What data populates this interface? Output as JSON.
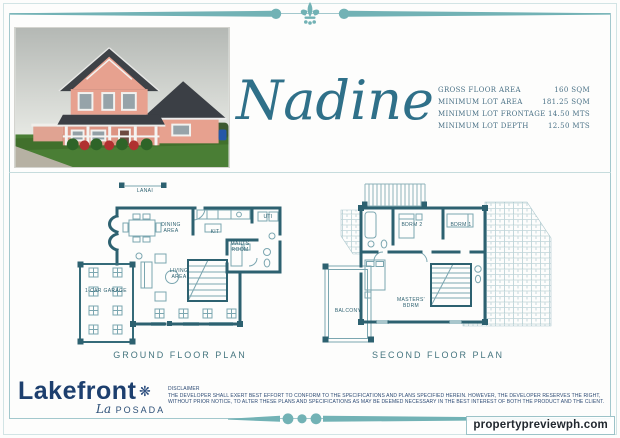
{
  "title": {
    "model_name": "Nadine"
  },
  "specs": {
    "rows": [
      {
        "label": "GROSS FLOOR AREA",
        "value": "160 SQM"
      },
      {
        "label": "MINIMUM LOT AREA",
        "value": "181.25 SQM"
      },
      {
        "label": "MINIMUM LOT FRONTAGE",
        "value": "14.50  MTS"
      },
      {
        "label": "MINIMUM LOT DEPTH",
        "value": "12.50  MTS"
      }
    ]
  },
  "ground_plan": {
    "caption": "GROUND FLOOR PLAN",
    "labels": {
      "lanai": "LANAI",
      "dining": "DINING AREA",
      "kitchen": "KIT",
      "utility": "UTI",
      "maids_room": "MAID'S ROOM",
      "living": "LIVING AREA",
      "garage": "1-CAR GARAGE"
    }
  },
  "second_plan": {
    "caption": "SECOND FLOOR PLAN",
    "labels": {
      "bdrm2": "BDRM 2",
      "bdrm1": "BDRM 1",
      "masters": "MASTERS' BDRM",
      "balcony": "BALCONY"
    }
  },
  "footer": {
    "brand": "Lakefront",
    "sub_brand_prefix": "La",
    "sub_brand": "POSADA",
    "disclaimer_heading": "DISCLAIMER",
    "disclaimer_line1": "THE DEVELOPER SHALL EXERT BEST EFFORT TO CONFORM TO THE SPECIFICATIONS AND PLANS SPECIFIED HEREIN. HOWEVER, THE DEVELOPER RESERVES THE RIGHT,",
    "disclaimer_line2": "WITHOUT PRIOR NOTICE, TO ALTER THESE PLANS AND SPECIFICATIONS AS MAY BE DEEMED NECESSARY IN THE BEST INTEREST OF BOTH THE PRODUCT AND THE CLIENT."
  },
  "watermark": "propertypreviewph.com",
  "icons": {
    "fleur_de_lis": "fleur-de-lis ornament",
    "flower_glyph": "❋"
  },
  "colors": {
    "ornament_teal": "#72b2b5",
    "plan_wall_teal": "#2d6170",
    "plan_light_teal": "#7ba6b0",
    "brand_navy": "#1d3f6e",
    "script_teal": "#2f7089",
    "house_pink": "#e7a18f",
    "roof_gray": "#3e4247"
  }
}
